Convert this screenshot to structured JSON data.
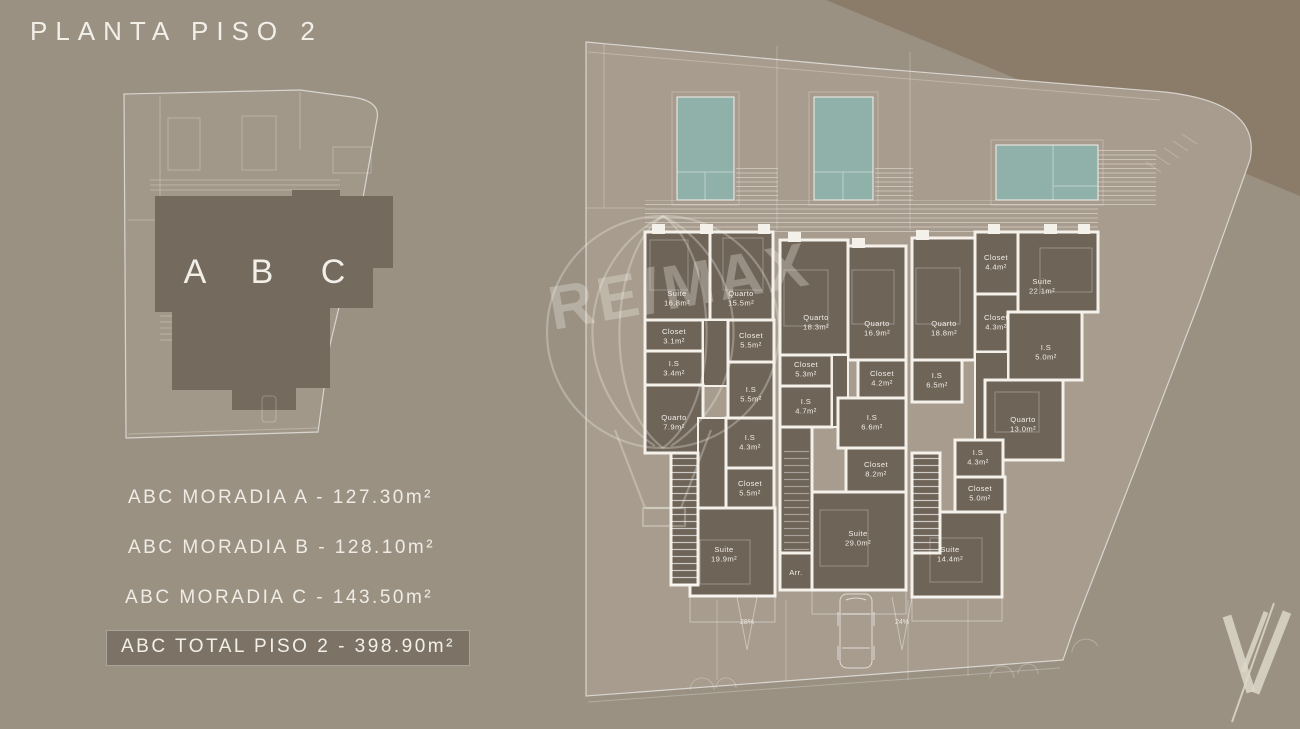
{
  "title": "PLANTA PISO 2",
  "site_overview": {
    "units": [
      "A",
      "B",
      "C"
    ]
  },
  "areas": {
    "moradia_a": "ABC MORADIA A - 127.30m²",
    "moradia_b": "ABC MORADIA B - 128.10m²",
    "moradia_c": "ABC MORADIA C - 143.50m²",
    "total": "ABC TOTAL PISO 2 - 398.90m²"
  },
  "floor_plan": {
    "storage_label": "Arr.",
    "ramp_labels": [
      "28%",
      "24%"
    ],
    "rooms": [
      {
        "name": "Suite",
        "area": "16.8m²"
      },
      {
        "name": "Quarto",
        "area": "15.5m²"
      },
      {
        "name": "Closet",
        "area": "3.1m²"
      },
      {
        "name": "I.S",
        "area": "3.4m²"
      },
      {
        "name": "Closet",
        "area": "5.5m²"
      },
      {
        "name": "I.S",
        "area": "5.5m²"
      },
      {
        "name": "Quarto",
        "area": "7.9m²"
      },
      {
        "name": "I.S",
        "area": "4.3m²"
      },
      {
        "name": "Closet",
        "area": "5.5m²"
      },
      {
        "name": "Suite",
        "area": "19.9m²"
      },
      {
        "name": "Quarto",
        "area": "18.3m²"
      },
      {
        "name": "Closet",
        "area": "5.3m²"
      },
      {
        "name": "I.S",
        "area": "4.7m²"
      },
      {
        "name": "Quarto",
        "area": "16.9m²"
      },
      {
        "name": "Closet",
        "area": "4.2m²"
      },
      {
        "name": "I.S",
        "area": "6.6m²"
      },
      {
        "name": "Closet",
        "area": "8.2m²"
      },
      {
        "name": "Suite",
        "area": "29.0m²"
      },
      {
        "name": "Quarto",
        "area": "18.8m²"
      },
      {
        "name": "I.S",
        "area": "6.5m²"
      },
      {
        "name": "Closet",
        "area": "4.4m²"
      },
      {
        "name": "Suite",
        "area": "22.1m²"
      },
      {
        "name": "Closet",
        "area": "4.3m²"
      },
      {
        "name": "I.S",
        "area": "5.0m²"
      },
      {
        "name": "Quarto",
        "area": "13.0m²"
      },
      {
        "name": "I.S",
        "area": "4.3m²"
      },
      {
        "name": "Closet",
        "area": "5.0m²"
      },
      {
        "name": "Suite",
        "area": "14.4m²"
      }
    ]
  },
  "watermark": {
    "text": "RE/MAX"
  },
  "colors": {
    "background": "#9a9183",
    "lot": "#a79c8d",
    "outside_lot": "#8b7c6a",
    "building": "#6f6458",
    "walls": "#f4f1ea",
    "pool": "#8fb1a9",
    "highlight_box": "#7c7366",
    "text": "#f1eee8"
  }
}
